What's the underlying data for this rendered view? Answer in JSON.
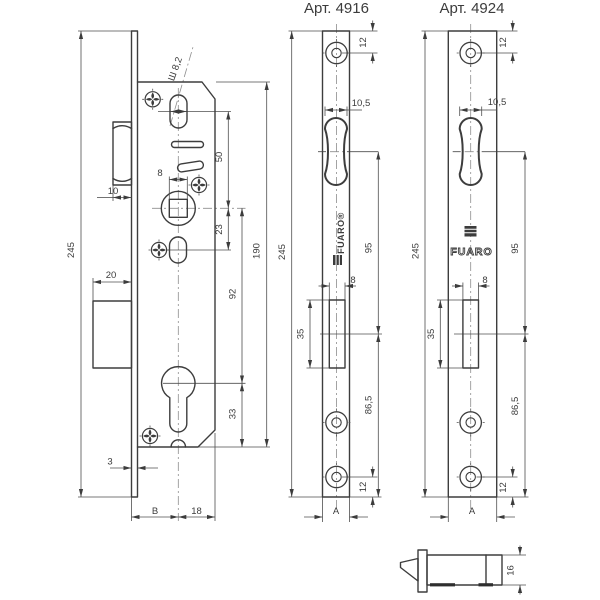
{
  "colors": {
    "line": "#3c3c3c",
    "background": "#ffffff"
  },
  "brand": {
    "logo_text": "FUARO",
    "logo_text_registered": "FUARO®"
  },
  "lock_body": {
    "height": "245",
    "slot_note": "Ш 8,2",
    "handle_to_spindle": "50",
    "spindle_square": "8",
    "latch_protrusion": "10",
    "spindle_to_fixing": "23",
    "body_height": "190",
    "spindle_to_cylinder": "92",
    "deadbolt_width": "20",
    "cylinder_to_bottom": "33",
    "plate_thickness": "3",
    "backset": "B",
    "cylinder_to_edge": "18"
  },
  "faceplate_4916": {
    "article": "Арт. 4916",
    "height": "245",
    "screw_top_offset": "12",
    "roller_width": "10,5",
    "roller_to_latch": "95",
    "latch_slot_width": "8",
    "latch_slot_height": "35",
    "latch_to_bottom": "86,5",
    "screw_bottom_offset": "12",
    "width": "A"
  },
  "faceplate_4924": {
    "article": "Арт. 4924",
    "height": "245",
    "screw_top_offset": "12",
    "roller_width": "10,5",
    "roller_to_latch": "95",
    "latch_slot_width": "8",
    "latch_slot_height": "35",
    "latch_to_bottom": "86,5",
    "screw_bottom_offset": "12",
    "width": "A"
  },
  "latch_detail": {
    "height": "16"
  }
}
